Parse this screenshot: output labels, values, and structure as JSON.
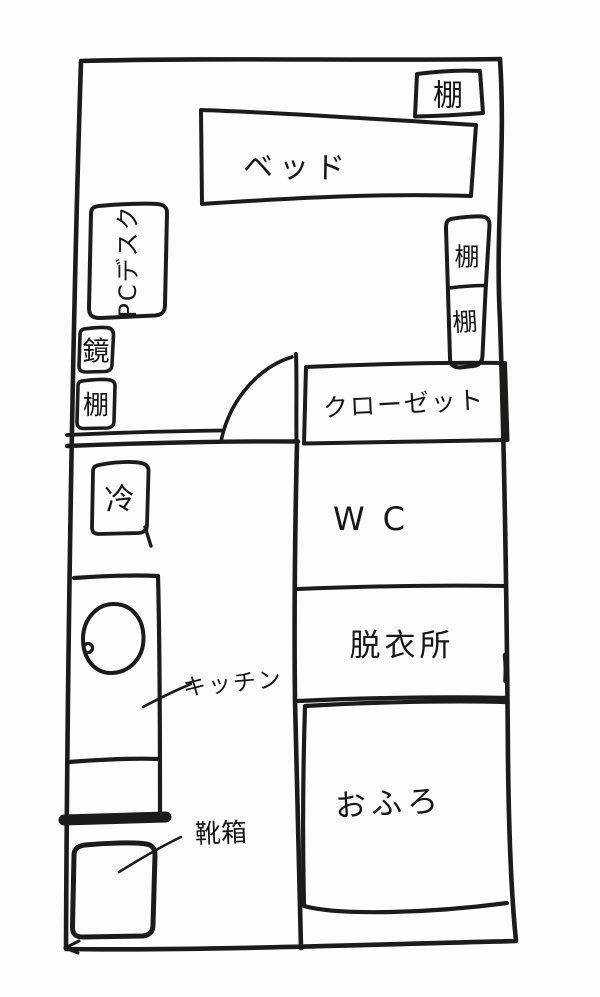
{
  "drawing": {
    "kind": "hand-drawn apartment floor plan",
    "ink_color": "#1b1b1b",
    "paper_color": "#fdfdfc"
  },
  "rooms": {
    "closet_label": "クローゼット",
    "wc_label": "WC",
    "dressing_room_label": "脱衣所",
    "bath_label": "おふろ"
  },
  "furniture": {
    "shelf_top_label": "棚",
    "bed_label": "ベッド",
    "pc_desk_label": "PCデスク",
    "mirror_label": "鏡",
    "shelf_left_label": "棚",
    "shelf_right_upper_label": "棚",
    "shelf_right_lower_label": "棚",
    "fridge_label": "冷",
    "kitchen_label": "キッチン",
    "shoe_box_label": "靴箱"
  }
}
